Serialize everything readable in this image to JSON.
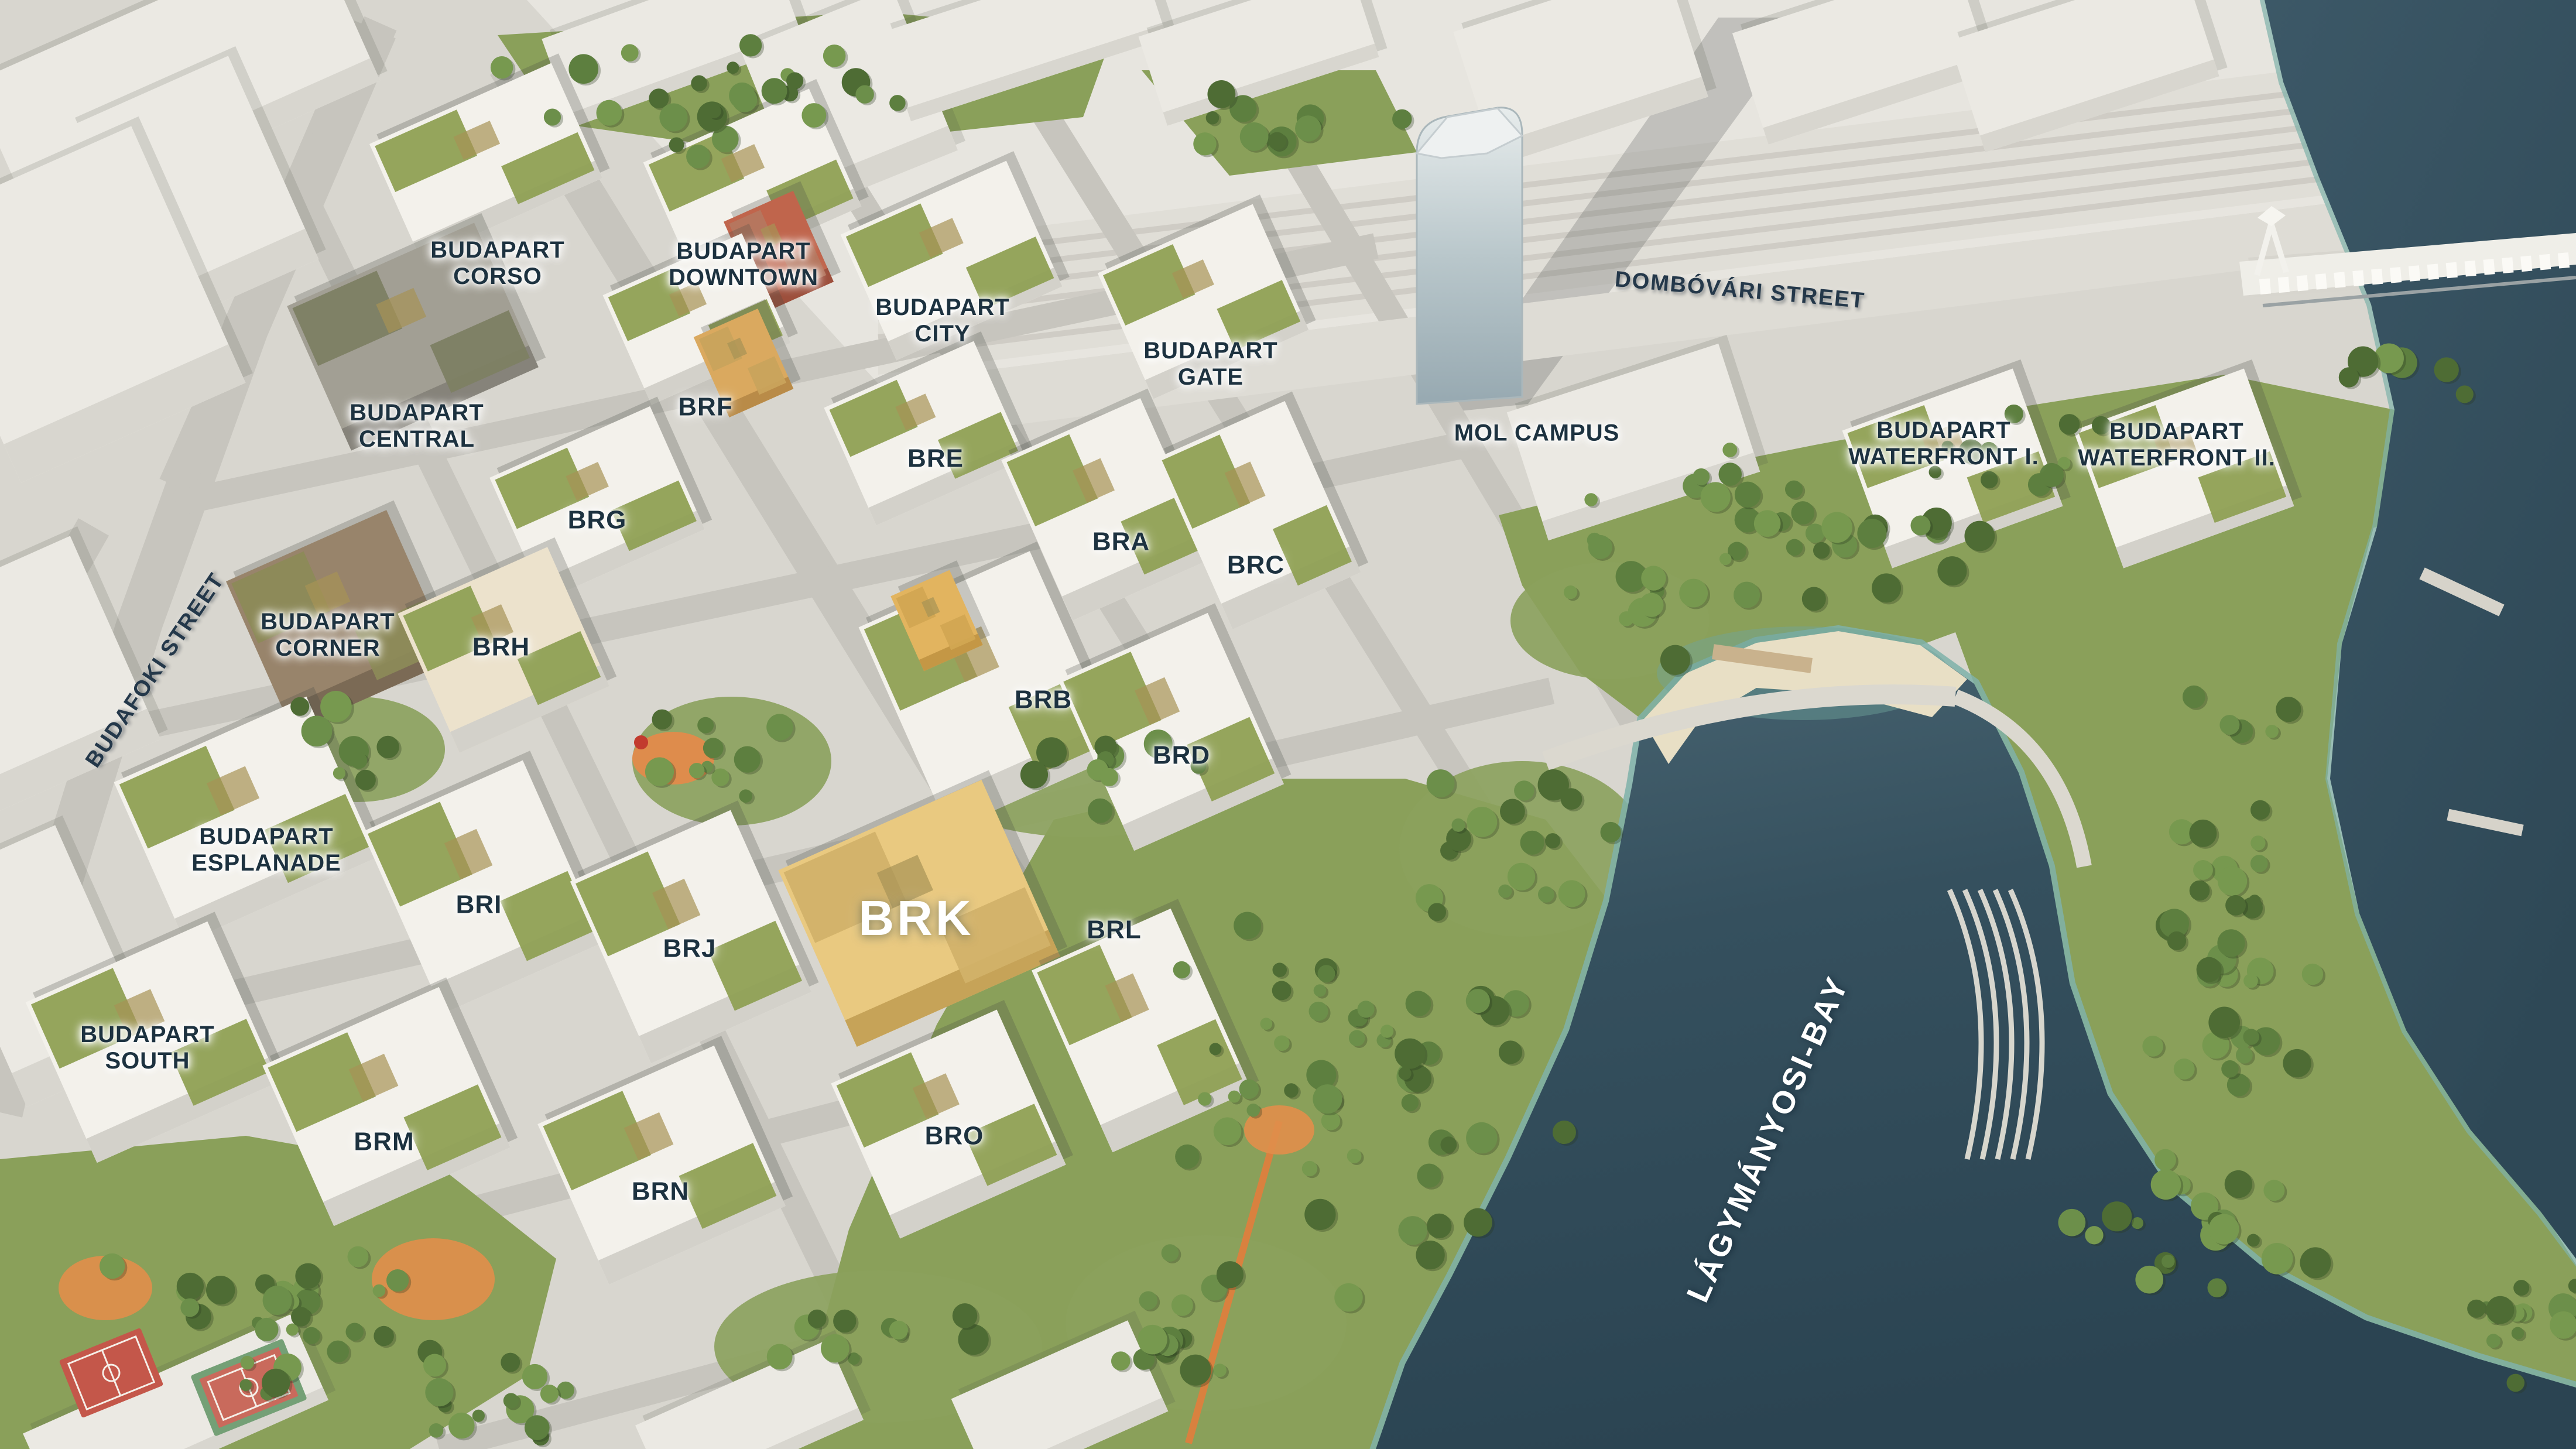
{
  "map": {
    "kind": "3d-aerial-masterplan-render",
    "area_labels": {
      "corso": {
        "text": "BUDAPART\nCORSO"
      },
      "downtown": {
        "text": "BUDAPART\nDOWNTOWN"
      },
      "city": {
        "text": "BUDAPART\nCITY"
      },
      "gate": {
        "text": "BUDAPART\nGATE"
      },
      "central": {
        "text": "BUDAPART\nCENTRAL"
      },
      "corner": {
        "text": "BUDAPART\nCORNER"
      },
      "esplanade": {
        "text": "BUDAPART\nESPLANADE"
      },
      "south": {
        "text": "BUDAPART\nSOUTH"
      },
      "waterfront1": {
        "text": "BUDAPART\nWATERFRONT I."
      },
      "waterfront2": {
        "text": "BUDAPART\nWATERFRONT II."
      },
      "molcampus": {
        "text": "MOL CAMPUS"
      }
    },
    "building_labels": {
      "bra": {
        "text": "BRA"
      },
      "brb": {
        "text": "BRB"
      },
      "brc": {
        "text": "BRC"
      },
      "brd": {
        "text": "BRD"
      },
      "bre": {
        "text": "BRE"
      },
      "brf": {
        "text": "BRF"
      },
      "brg": {
        "text": "BRG"
      },
      "brh": {
        "text": "BRH"
      },
      "bri": {
        "text": "BRI"
      },
      "brj": {
        "text": "BRJ"
      },
      "brl": {
        "text": "BRL"
      },
      "brm": {
        "text": "BRM"
      },
      "brn": {
        "text": "BRN"
      },
      "bro": {
        "text": "BRO"
      }
    },
    "highlight_label": {
      "text": "BRK"
    },
    "street_labels": {
      "dombovari": {
        "text": "DOMBÓVÁRI STREET"
      },
      "budafoki": {
        "text": "BUDAFOKI STREET"
      }
    },
    "water_labels": {
      "bay": {
        "text": "LÁGYMÁNYOSI-BAY"
      }
    },
    "colors": {
      "label_dark": "#1d3240",
      "label_light": "#ffffff",
      "water_deep": "#2e4857",
      "water_shallow": "#7fb2a9",
      "grass": "#8aa05a",
      "roof_green": "#8fa054",
      "highlight_building": "#e9c980",
      "sand": "#e8dfc5",
      "court_red": "#c4574a",
      "playground_orange": "#df8e4b",
      "road": "#c9c7c0"
    }
  }
}
